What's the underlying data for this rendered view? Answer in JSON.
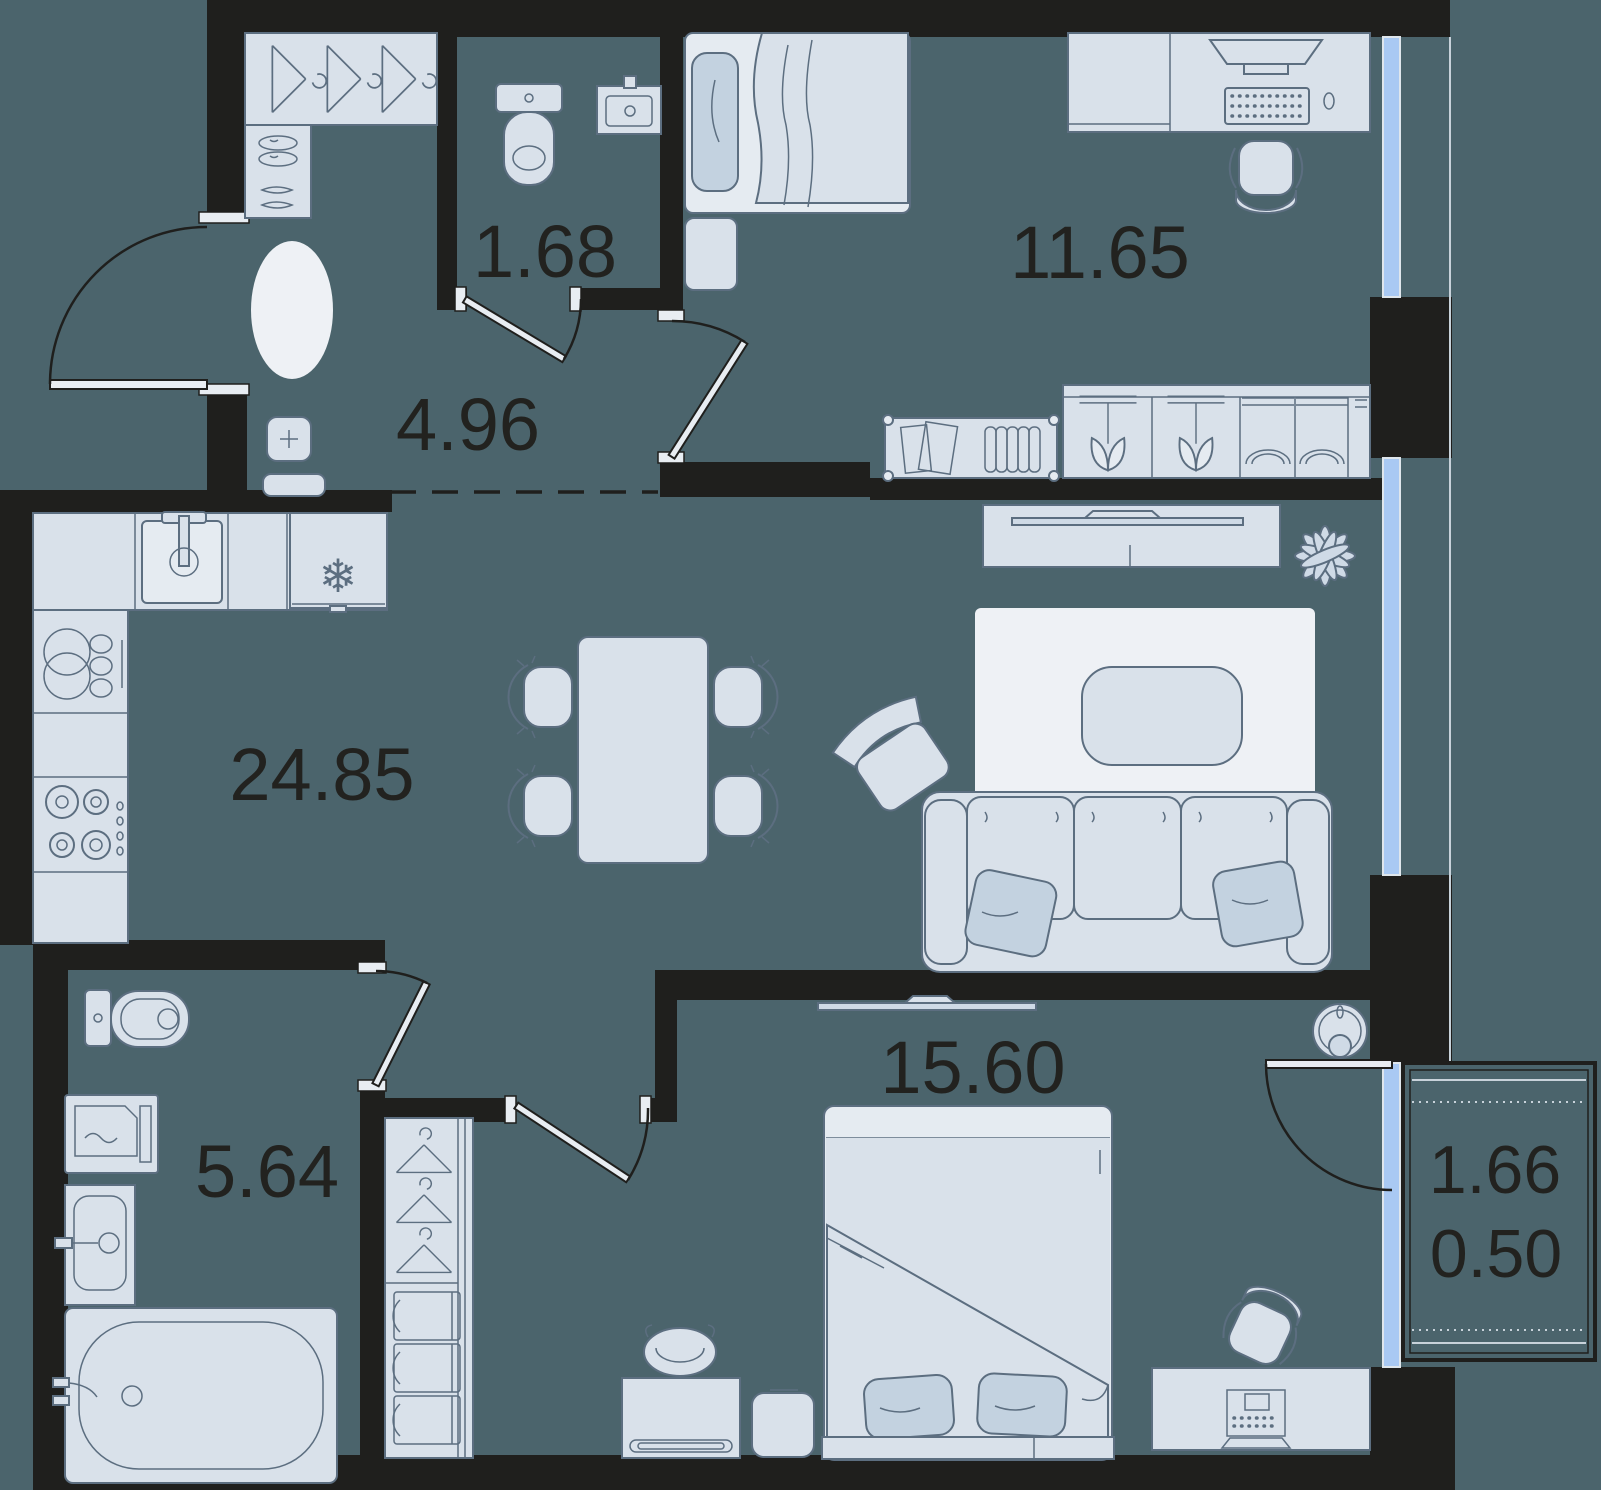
{
  "plan": {
    "type": "apartment-floor-plan",
    "rooms": [
      {
        "id": "wc",
        "area": "1.68"
      },
      {
        "id": "hallway",
        "area": "4.96"
      },
      {
        "id": "bedroom",
        "area": "11.65"
      },
      {
        "id": "kitchen-living-room",
        "area": "24.85"
      },
      {
        "id": "bathroom",
        "area": "5.64"
      },
      {
        "id": "master-bedroom",
        "area": "15.60"
      },
      {
        "id": "balcony-area",
        "area": "1.66"
      },
      {
        "id": "balcony-reduced-area",
        "area": "0.50"
      }
    ],
    "icons": {
      "fridge-icon": "❄"
    },
    "colors": {
      "background": "#4b646c",
      "walls": "#1f1f1d",
      "furniture_fill": "#d9e1ea",
      "furniture_outline": "#5c6e80",
      "accent_fill": "#c3d2e0",
      "rug_fill": "#e9eef3",
      "window_glass": "#a9c9f3",
      "label_text": "#22221f"
    }
  }
}
